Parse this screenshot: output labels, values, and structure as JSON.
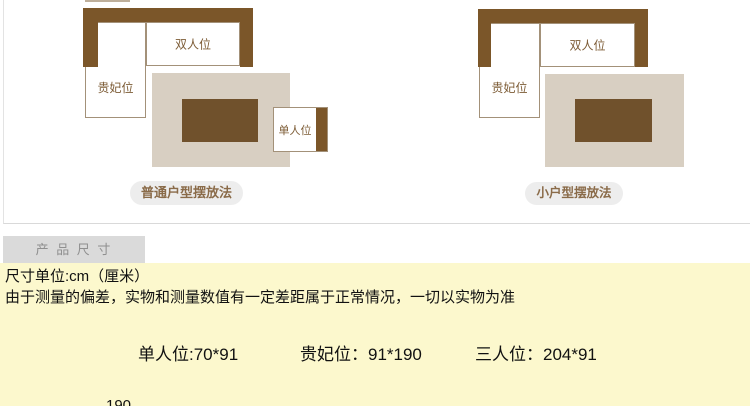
{
  "diagrams": {
    "normal": {
      "caption": "普通户型摆放法",
      "labels": {
        "double_seat": "双人位",
        "chaise": "贵妃位",
        "single_seat": "单人位"
      }
    },
    "small": {
      "caption": "小户型摆放法",
      "labels": {
        "double_seat": "双人位",
        "chaise": "贵妃位"
      }
    }
  },
  "size_section": {
    "tab_label": "产 品 尺 寸",
    "unit_line": "尺寸单位:cm（厘米）",
    "note_line": "由于测量的偏差，实物和测量数值有一定差距属于正常情况，一切以实物为准",
    "dimensions": [
      "单人位:70*91",
      "贵妃位：91*190",
      "三人位：204*91"
    ],
    "partial_bottom_text": "190"
  },
  "colors": {
    "sofa_brown": "#7b5629",
    "table_brown": "#70512c",
    "rug_beige": "#d8cfc2",
    "box_border": "#a39179",
    "seat_label_brown": "#7d5c36",
    "caption_brown": "#8a6b49",
    "caption_pill_gray": "#ededed",
    "tab_bg_gray": "#dadada",
    "tab_text_gray": "#8f8f8f",
    "panel_border_gray": "#d9d9d9",
    "highlight_yellow": "#fcf8cd",
    "text_black": "#111111"
  }
}
